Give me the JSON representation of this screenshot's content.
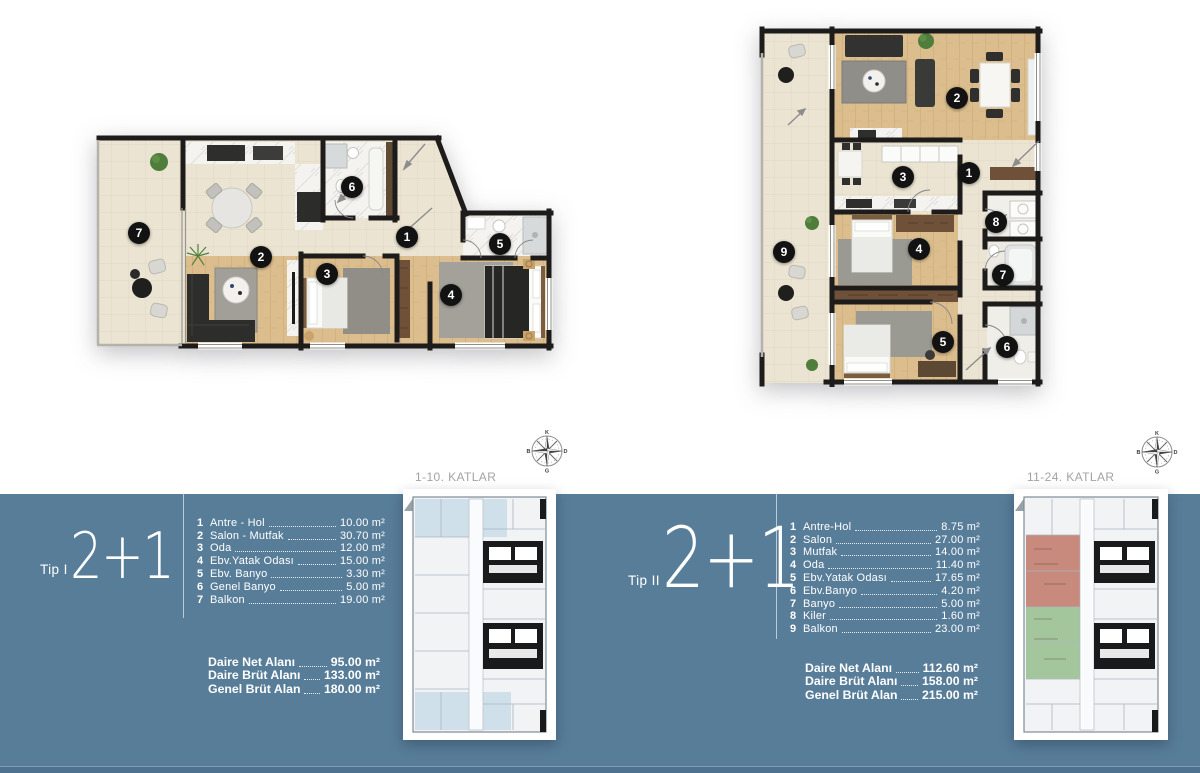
{
  "panels": [
    {
      "id": "tip1",
      "tip": "Tip I",
      "type": "2+1",
      "floors": "1-10. KATLAR",
      "rooms": [
        {
          "num": "1",
          "name": "Antre - Hol",
          "area": "10.00 m²"
        },
        {
          "num": "2",
          "name": "Salon - Mutfak",
          "area": "30.70 m²"
        },
        {
          "num": "3",
          "name": "Oda",
          "area": "12.00 m²"
        },
        {
          "num": "4",
          "name": "Ebv.Yatak Odası",
          "area": "15.00 m²"
        },
        {
          "num": "5",
          "name": "Ebv. Banyo",
          "area": "3.30 m²"
        },
        {
          "num": "6",
          "name": "Genel Banyo",
          "area": "5.00 m²"
        },
        {
          "num": "7",
          "name": "Balkon",
          "area": "19.00 m²"
        }
      ],
      "totals": [
        {
          "label": "Daire Net Alanı",
          "value": "95.00 m²"
        },
        {
          "label": "Daire Brüt Alanı",
          "value": "133.00 m²"
        },
        {
          "label": "Genel Brüt Alan",
          "value": "180.00 m²"
        }
      ]
    },
    {
      "id": "tip2",
      "tip": "Tip II",
      "type": "2+1",
      "floors": "11-24. KATLAR",
      "rooms": [
        {
          "num": "1",
          "name": "Antre-Hol",
          "area": "8.75 m²"
        },
        {
          "num": "2",
          "name": "Salon",
          "area": "27.00 m²"
        },
        {
          "num": "3",
          "name": "Mutfak",
          "area": "14.00 m²"
        },
        {
          "num": "4",
          "name": "Oda",
          "area": "11.40 m²"
        },
        {
          "num": "5",
          "name": "Ebv.Yatak Odası",
          "area": "17.65 m²"
        },
        {
          "num": "6",
          "name": "Ebv.Banyo",
          "area": "4.20 m²"
        },
        {
          "num": "7",
          "name": "Banyo",
          "area": "5.00 m²"
        },
        {
          "num": "8",
          "name": "Kiler",
          "area": "1.60 m²"
        },
        {
          "num": "9",
          "name": "Balkon",
          "area": "23.00 m²"
        }
      ],
      "totals": [
        {
          "label": "Daire Net Alanı",
          "value": "112.60 m²"
        },
        {
          "label": "Daire Brüt Alanı",
          "value": "158.00 m²"
        },
        {
          "label": "Genel Brüt Alan",
          "value": "215.00 m²"
        }
      ]
    }
  ],
  "compass": {
    "north": "K",
    "east": "D",
    "south": "G",
    "west": "B"
  },
  "colors": {
    "band": "#587d99",
    "highlight_red": "#c88a7d",
    "highlight_green": "#a4c69d",
    "keyplan_blue": "#cfe0ea",
    "wall": "#1d1c1a"
  }
}
